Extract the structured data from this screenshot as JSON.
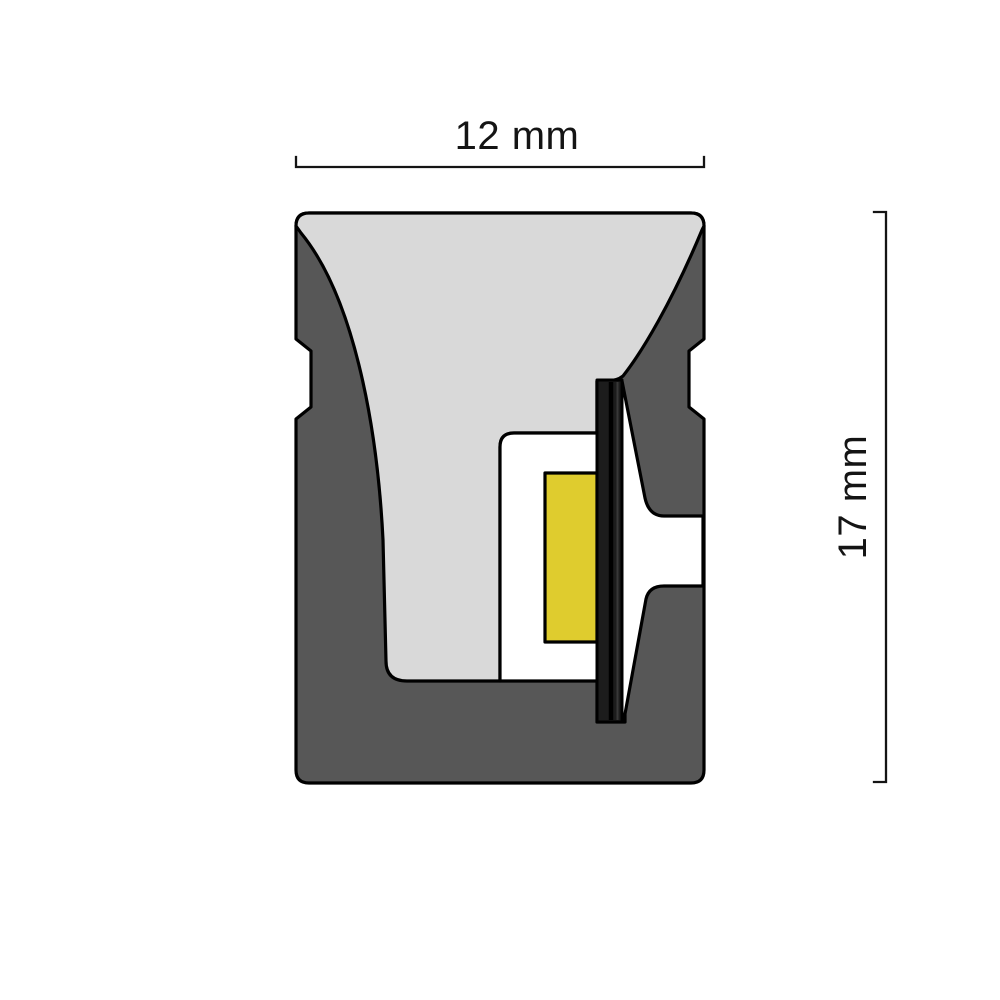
{
  "dimensions": {
    "width": "12 mm",
    "height": "17 mm"
  },
  "colors": {
    "background": "#ffffff",
    "outline": "#000000",
    "jacket_gray": "#575757",
    "diffuser_gray": "#d9d9d9",
    "cavity_white": "#ffffff",
    "led_yellow": "#dfcc2e",
    "pcb_dark": "#1c1c1c",
    "pcb_divider": "#000000",
    "pcb_highlight": "#383838",
    "dimension_text": "#141414"
  }
}
